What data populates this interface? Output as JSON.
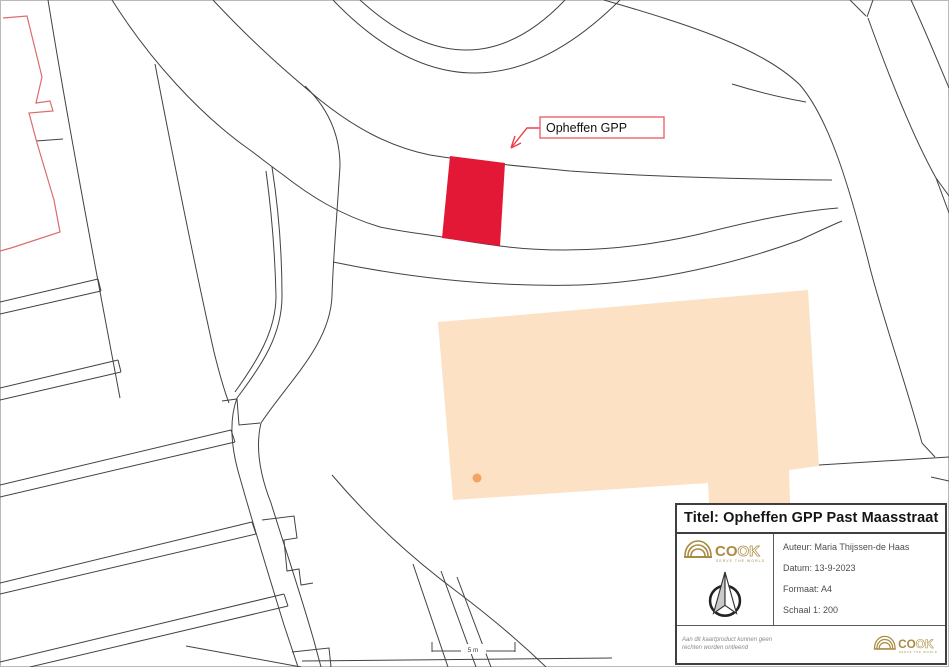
{
  "map": {
    "annotation": {
      "label": "Opheffen GPP"
    },
    "scale_bar": {
      "label": "5 m"
    },
    "colors": {
      "line": "#424242",
      "parcel_red": "#e21836",
      "label_border": "#e8636f",
      "arrow_red": "#e8414f",
      "red_outline_building": "#dd6b6b",
      "building_fill": "#fce1c4",
      "building_stroke": "#ef8b2f",
      "building_dot_fill": "#f2a562",
      "gold": "#a98b42"
    }
  },
  "title_block": {
    "title": "Titel: Opheffen GPP Past Maasstraat",
    "author": "Auteur: Maria Thijssen-de Haas",
    "date": "Datum: 13-9-2023",
    "format": "Formaat: A4",
    "scale": "Schaal 1: 200",
    "disclaimer_line1": "Aan dit kaartproduct kunnen geen",
    "disclaimer_line2": "rechten worden ontleend",
    "logo": {
      "part1": "CO",
      "part2": "OK",
      "tagline": "SERVE THE WORLD"
    }
  }
}
